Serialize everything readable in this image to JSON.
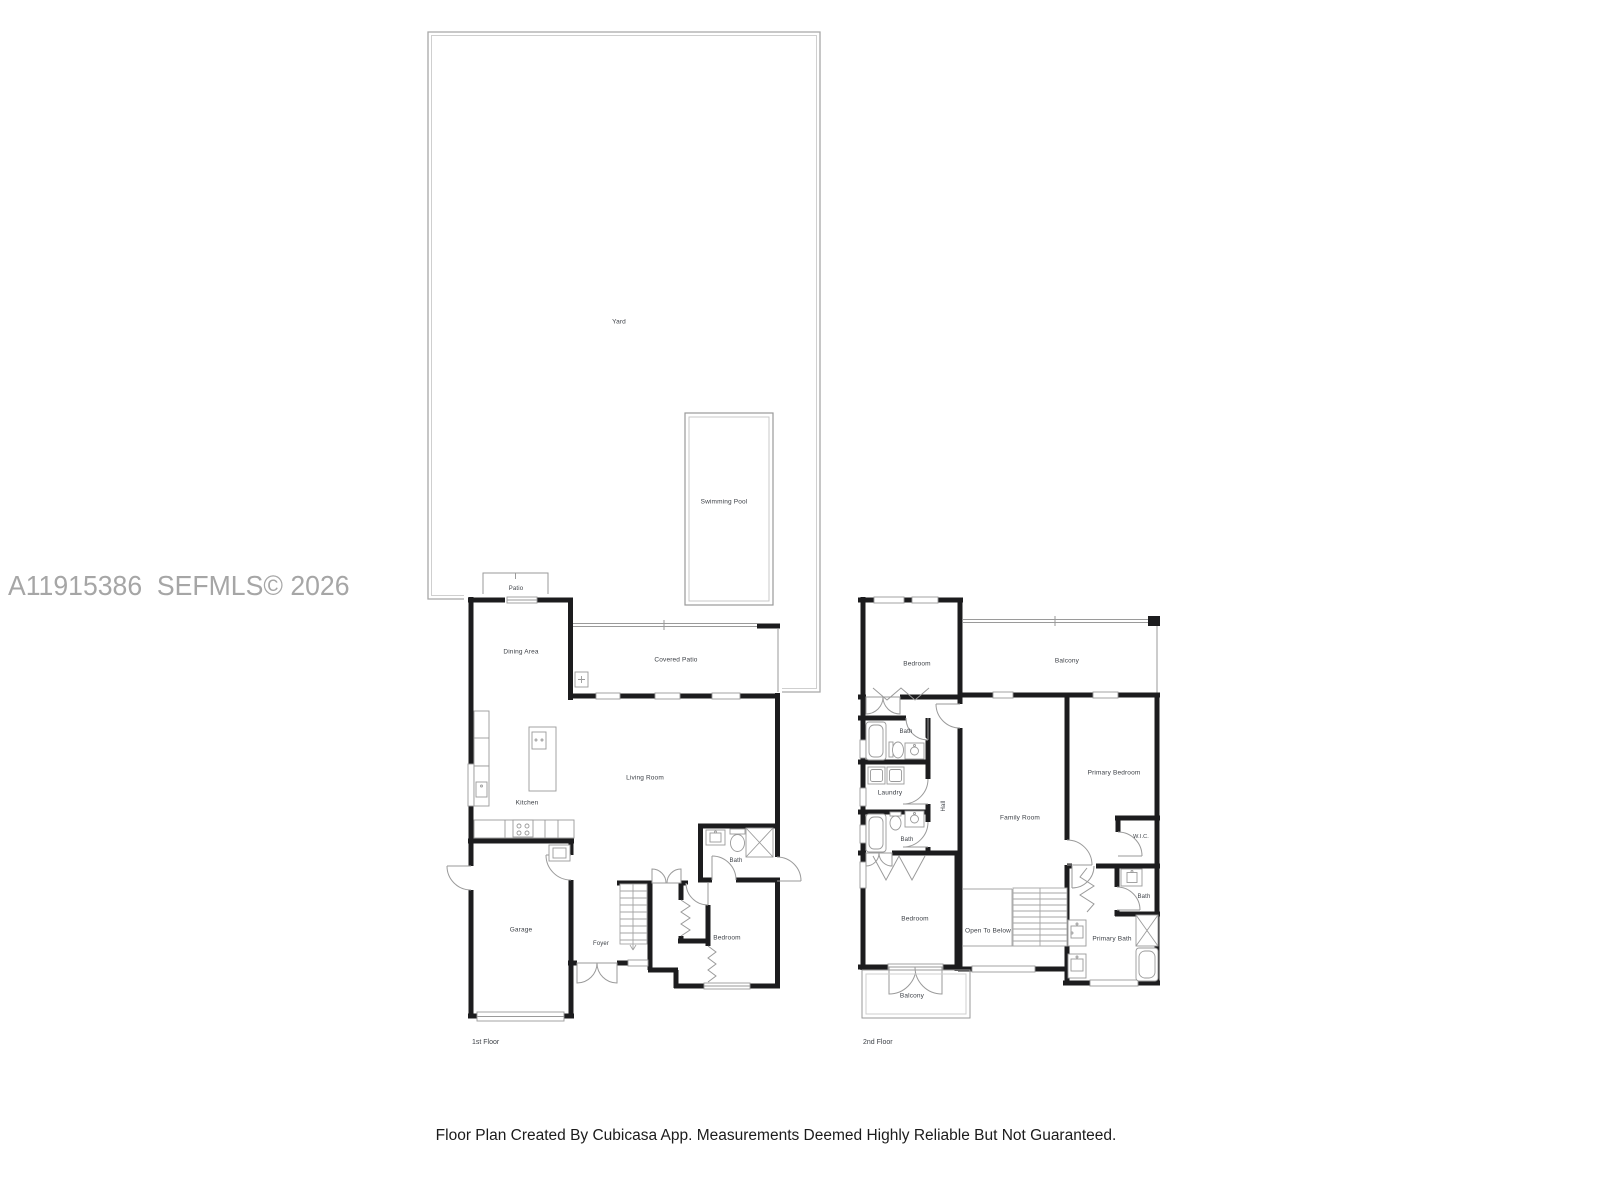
{
  "watermark": "A11915386  SEFMLS© 2026",
  "caption": "Floor Plan Created By Cubicasa App. Measurements Deemed Highly Reliable But Not Guaranteed.",
  "colors": {
    "wall": "#1c1c1e",
    "thin_line": "#9a9a9a",
    "label_text": "#3d4147",
    "watermark_text": "#a6a6a6",
    "caption_text": "#1b1b1b"
  },
  "floor1": {
    "label": "1st Floor",
    "rooms": {
      "yard": "Yard",
      "swimming_pool": "Swimming Pool",
      "patio": "Patio",
      "dining_area": "Dining Area",
      "covered_patio": "Covered Patio",
      "kitchen": "Kitchen",
      "living_room": "Living Room",
      "bath": "Bath",
      "garage": "Garage",
      "foyer": "Foyer",
      "bedroom": "Bedroom"
    }
  },
  "floor2": {
    "label": "2nd Floor",
    "rooms": {
      "bedroom_top": "Bedroom",
      "balcony_top": "Balcony",
      "bath_top": "Bath",
      "laundry": "Laundry",
      "hall": "Hall",
      "bath_mid": "Bath",
      "family_room": "Family Room",
      "primary_bedroom": "Primary Bedroom",
      "wic": "W.I.C.",
      "bedroom_bottom": "Bedroom",
      "open_to_below": "Open To Below",
      "bath_right": "Bath",
      "primary_bath": "Primary Bath",
      "balcony_bottom": "Balcony"
    }
  }
}
